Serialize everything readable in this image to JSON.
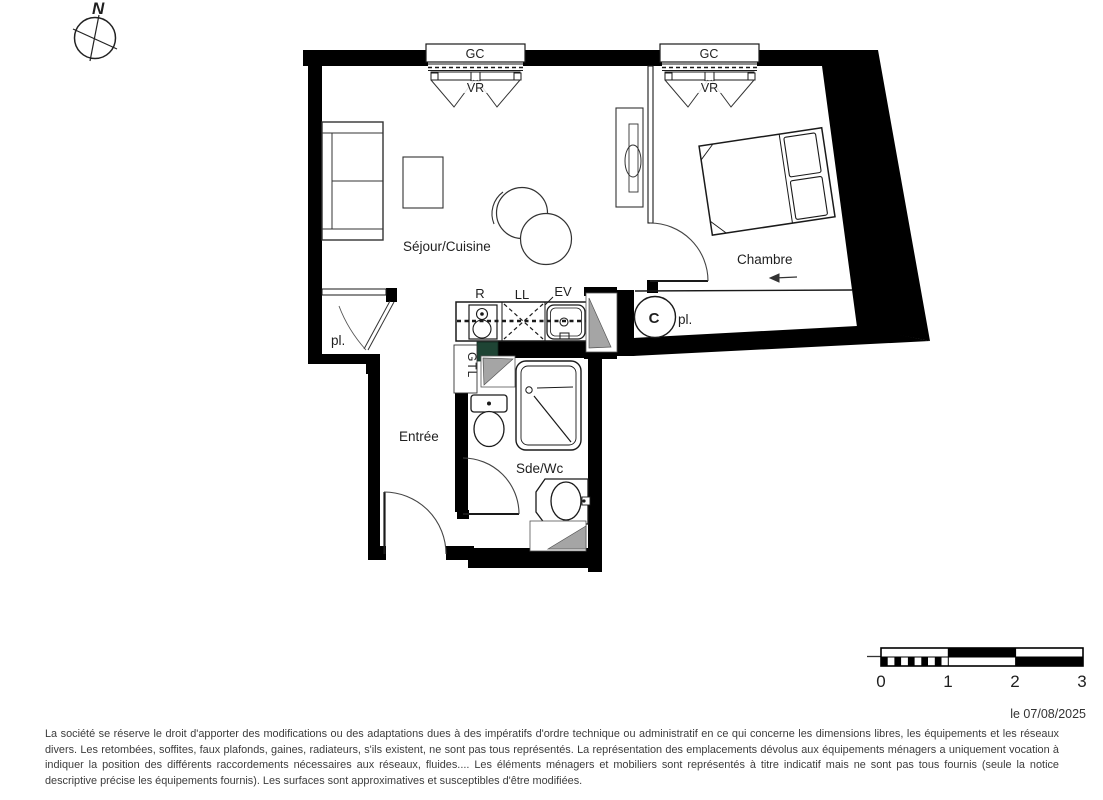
{
  "compass": {
    "north": "N"
  },
  "windows": {
    "gc": "GC",
    "vr": "VR"
  },
  "rooms": {
    "living": "Séjour/Cuisine",
    "bedroom": "Chambre",
    "entry": "Entrée",
    "bathroom": "Sde/Wc"
  },
  "fixtures": {
    "fridge": "R",
    "washing_machine": "LL",
    "sink": "EV",
    "gtl": "GTL",
    "water_heater": "C",
    "closet_living": "pl.",
    "closet_bedroom": "pl."
  },
  "scale_bar": {
    "ticks": [
      "0",
      "1",
      "2",
      "3"
    ]
  },
  "footer": {
    "date": "le 07/08/2025",
    "disclaimer": "La société se réserve le droit d'apporter des modifications ou des adaptations dues à des impératifs d'ordre technique ou administratif en ce qui concerne les dimensions libres, les équipements et les réseaux divers. Les retombées, soffites, faux plafonds, gaines, radiateurs, s'ils existent, ne sont pas tous représentés. La représentation des emplacements dévolus aux équipements ménagers a uniquement vocation à indiquer la position des différents raccordements nécessaires aux réseaux, fluides.... Les éléments ménagers et mobiliers sont représentés à titre indicatif mais ne sont pas tous fournis (seule la notice descriptive précise les équipements fournis). Les surfaces sont approximatives et susceptibles d'être modifiées."
  },
  "colors": {
    "wall": "#000000",
    "gtl_green": "#1e4434",
    "door_gray": "#a5a5a5"
  }
}
